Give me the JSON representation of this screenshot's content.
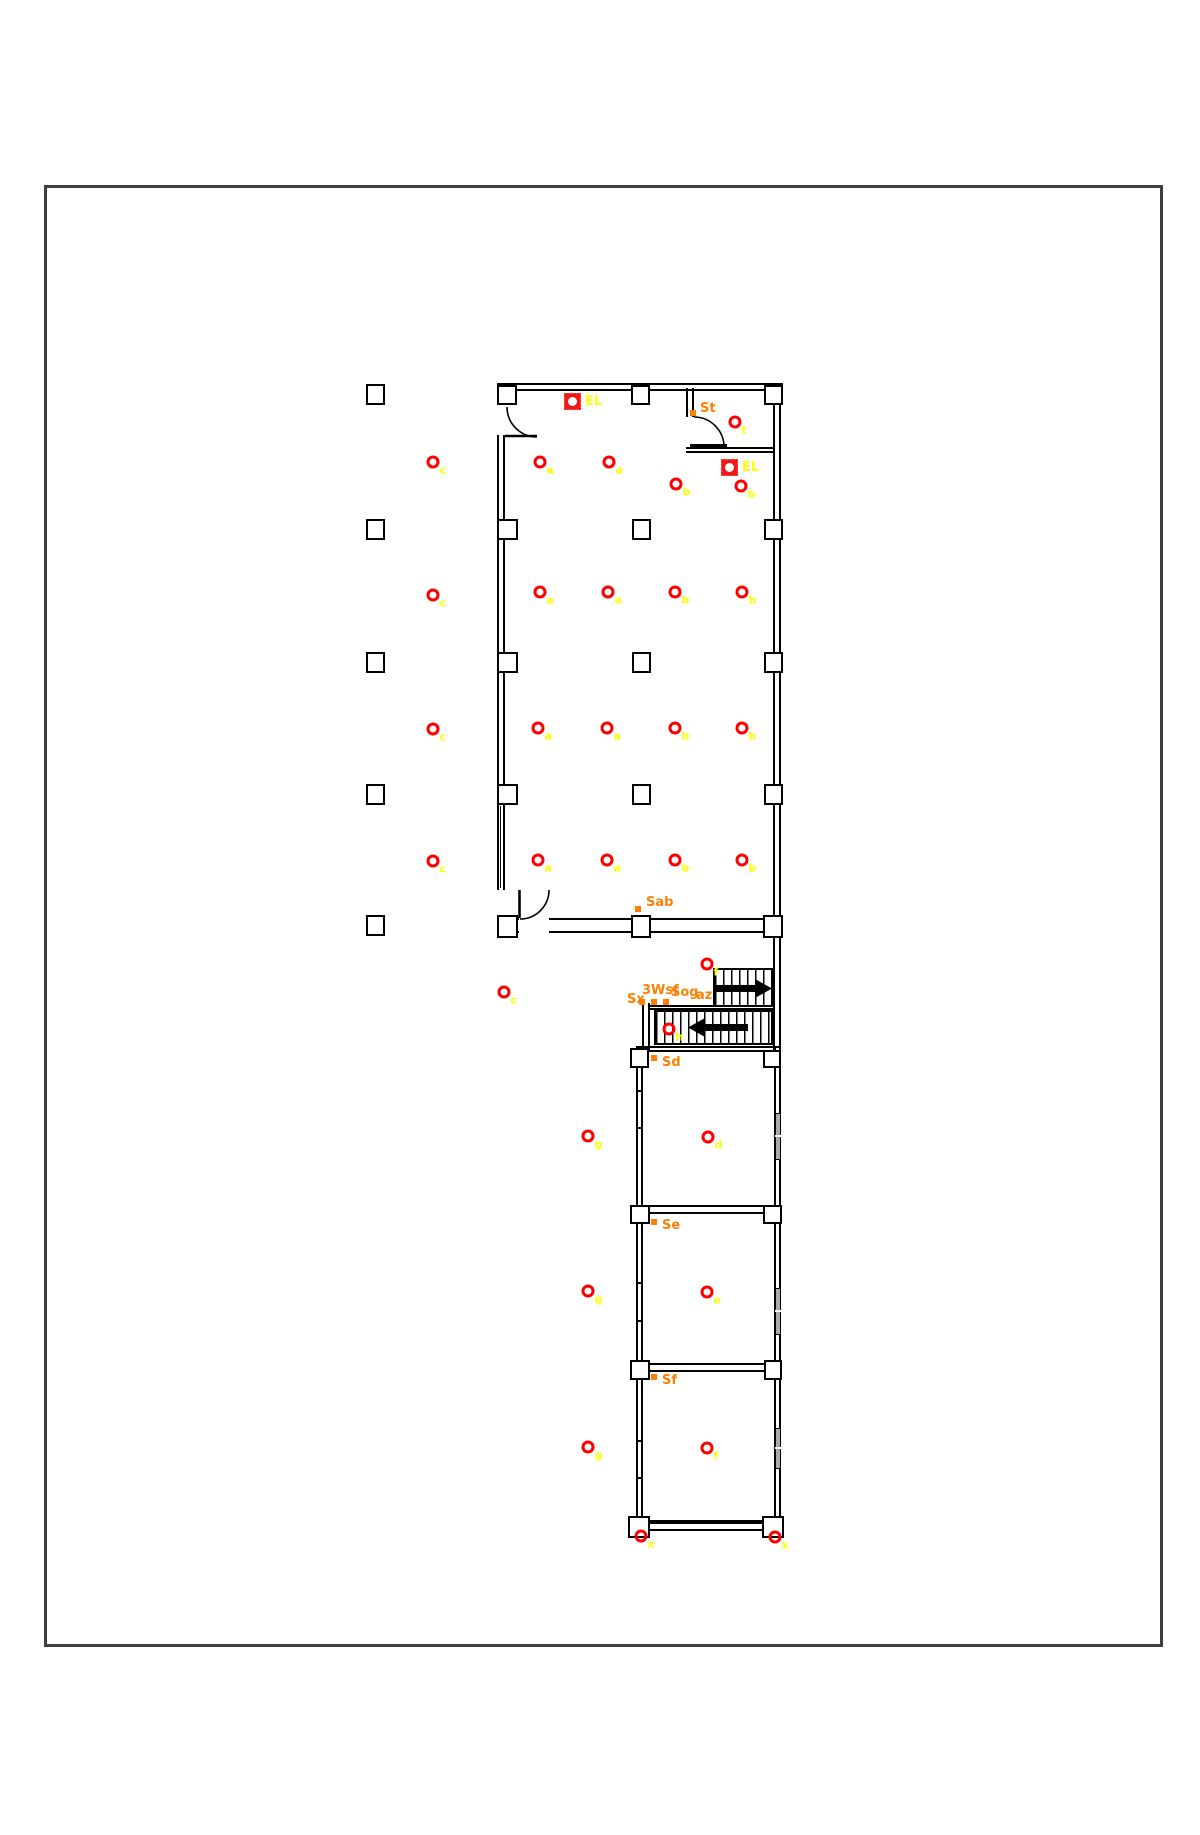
{
  "colors": {
    "wall": "#000000",
    "border": "#3f3f3f",
    "light_symbol": "#ff0000",
    "light_label": "#ffff00",
    "annotation": "#ff8000",
    "window_glass": "#a9a9a9",
    "arrow": "#000000"
  },
  "el_panels": [
    {
      "label": "EL",
      "x": 564,
      "y": 393
    },
    {
      "label": "EL",
      "x": 721,
      "y": 459
    }
  ],
  "lights": [
    {
      "label": "t",
      "x": 735,
      "y": 422
    },
    {
      "label": "c",
      "x": 433,
      "y": 462
    },
    {
      "label": "a",
      "x": 540,
      "y": 462
    },
    {
      "label": "a",
      "x": 609,
      "y": 462
    },
    {
      "label": "b",
      "x": 676,
      "y": 484
    },
    {
      "label": "b",
      "x": 741,
      "y": 486
    },
    {
      "label": "c",
      "x": 433,
      "y": 595
    },
    {
      "label": "a",
      "x": 540,
      "y": 592
    },
    {
      "label": "a",
      "x": 608,
      "y": 592
    },
    {
      "label": "b",
      "x": 675,
      "y": 592
    },
    {
      "label": "b",
      "x": 742,
      "y": 592
    },
    {
      "label": "c",
      "x": 433,
      "y": 729
    },
    {
      "label": "a",
      "x": 538,
      "y": 728
    },
    {
      "label": "a",
      "x": 607,
      "y": 728
    },
    {
      "label": "b",
      "x": 675,
      "y": 728
    },
    {
      "label": "b",
      "x": 742,
      "y": 728
    },
    {
      "label": "c",
      "x": 433,
      "y": 861
    },
    {
      "label": "a",
      "x": 538,
      "y": 860
    },
    {
      "label": "a",
      "x": 607,
      "y": 860
    },
    {
      "label": "b",
      "x": 675,
      "y": 860
    },
    {
      "label": "b",
      "x": 742,
      "y": 860
    },
    {
      "label": "f",
      "x": 707,
      "y": 964
    },
    {
      "label": "c",
      "x": 504,
      "y": 992
    },
    {
      "label": "h",
      "x": 669,
      "y": 1029
    },
    {
      "label": "g",
      "x": 588,
      "y": 1136
    },
    {
      "label": "d",
      "x": 708,
      "y": 1137
    },
    {
      "label": "g",
      "x": 588,
      "y": 1291
    },
    {
      "label": "e",
      "x": 707,
      "y": 1292
    },
    {
      "label": "g",
      "x": 588,
      "y": 1447
    },
    {
      "label": "f",
      "x": 707,
      "y": 1448
    },
    {
      "label": "x",
      "x": 641,
      "y": 1536
    },
    {
      "label": "x",
      "x": 775,
      "y": 1537
    }
  ],
  "annotations": [
    {
      "text": "St",
      "x": 700,
      "y": 402
    },
    {
      "text": "Sab",
      "x": 646,
      "y": 896
    },
    {
      "text": "Sx",
      "x": 627,
      "y": 993
    },
    {
      "text": "3Wsf",
      "x": 642,
      "y": 984
    },
    {
      "text": "Sog",
      "x": 671,
      "y": 986
    },
    {
      "text": "az",
      "x": 696,
      "y": 989
    },
    {
      "text": "Sd",
      "x": 662,
      "y": 1056
    },
    {
      "text": "Se",
      "x": 662,
      "y": 1219
    },
    {
      "text": "Sf",
      "x": 662,
      "y": 1374
    }
  ],
  "markers": [
    {
      "x": 690,
      "y": 410
    },
    {
      "x": 635,
      "y": 906
    },
    {
      "x": 639,
      "y": 999
    },
    {
      "x": 651,
      "y": 999
    },
    {
      "x": 663,
      "y": 999
    },
    {
      "x": 651,
      "y": 1055
    },
    {
      "x": 651,
      "y": 1219
    },
    {
      "x": 651,
      "y": 1374
    }
  ]
}
